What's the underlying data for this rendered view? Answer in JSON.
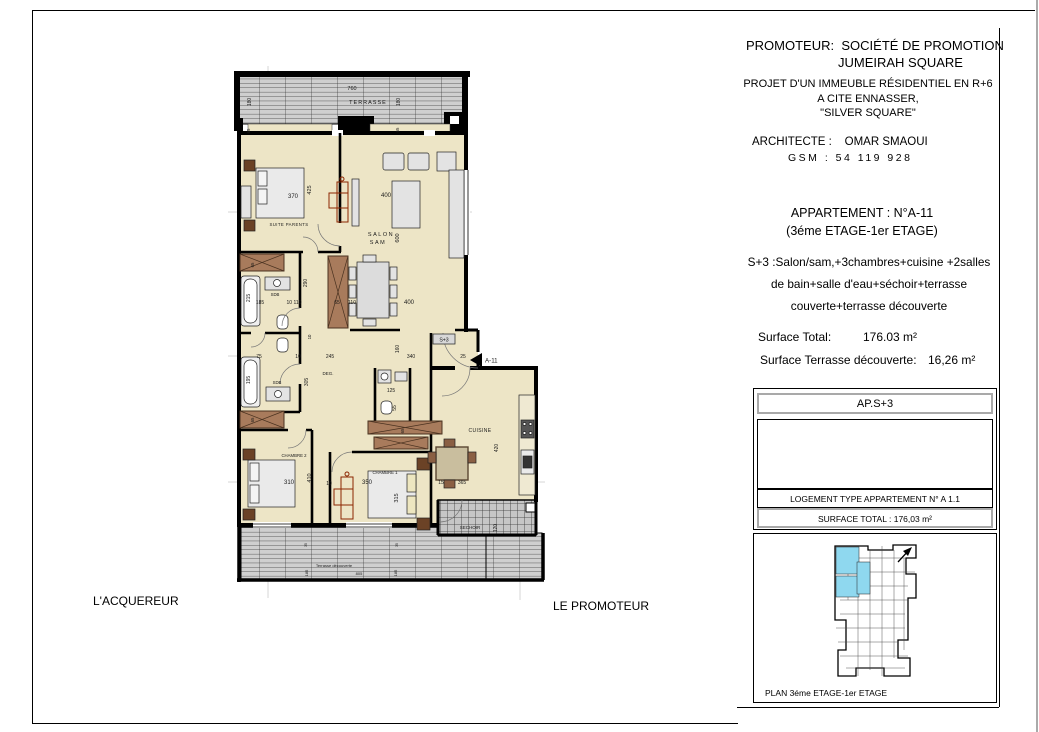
{
  "header": {
    "promoteur_label": "PROMOTEUR:",
    "promoteur_name1": "SOCIÉTÉ DE PROMOTION",
    "promoteur_name2": "JUMEIRAH SQUARE",
    "projet1": "PROJET D'UN IMMEUBLE RÉSIDENTIEL EN  R+6",
    "projet2": "A CITE ENNASSER,",
    "projet3": "\"SILVER SQUARE\"",
    "architecte_label": "ARCHITECTE :",
    "architecte_name": "OMAR SMAOUI",
    "gsm": "GSM : 54 119 928"
  },
  "apartment": {
    "line1": "APPARTEMENT : N°A-11",
    "line2": "(3éme ETAGE-1er ETAGE)",
    "desc1": "S+3 :Salon/sam,+3chambres+cuisine +2salles",
    "desc2": "de bain+salle d'eau+séchoir+terrasse",
    "desc3": "couverte+terrasse découverte",
    "surface_total_label": "Surface Total:",
    "surface_total_value": "176.03 m²",
    "surface_terrasse_label": "Surface Terrasse découverte:",
    "surface_terrasse_value": "16,26 m²"
  },
  "cartouche": {
    "type": "AP.S+3",
    "logement": "LOGEMENT TYPE APPARTEMENT N° A 1.1",
    "surface": "SURFACE TOTAL : 176,03 m²",
    "caption": "PLAN 3éme ETAGE-1er ETAGE"
  },
  "signatures": {
    "acquereur": "L'ACQUEREUR",
    "promoteur": "LE PROMOTEUR"
  },
  "plan": {
    "entrance_tag": "A-11",
    "type_tag": "S+3",
    "labels": [
      {
        "t": "760",
        "x": 352,
        "y": 90,
        "s": 5.5
      },
      {
        "t": "TERRASSE",
        "x": 368,
        "y": 104,
        "s": 5.5,
        "ls": 1
      },
      {
        "t": "180",
        "x": 251,
        "y": 102,
        "s": 5,
        "r": -90
      },
      {
        "t": "180",
        "x": 400,
        "y": 102,
        "s": 5,
        "r": -90
      },
      {
        "t": "65",
        "x": 250,
        "y": 131,
        "s": 4.3,
        "r": -90
      },
      {
        "t": "65",
        "x": 399,
        "y": 130,
        "s": 4.3,
        "r": -90
      },
      {
        "t": "370",
        "x": 293,
        "y": 198,
        "s": 6
      },
      {
        "t": "425",
        "x": 311,
        "y": 190,
        "s": 5.5,
        "r": -90
      },
      {
        "t": "SUITE PARENTS",
        "x": 289,
        "y": 226,
        "s": 4.3,
        "ls": 0.4
      },
      {
        "t": "400",
        "x": 386,
        "y": 197,
        "s": 6
      },
      {
        "t": "SALON",
        "x": 381,
        "y": 236,
        "s": 5.5,
        "ls": 1.5
      },
      {
        "t": "SAM",
        "x": 378,
        "y": 244,
        "s": 5.5,
        "ls": 1.5
      },
      {
        "t": "600",
        "x": 399,
        "y": 238,
        "s": 5.5,
        "r": -90
      },
      {
        "t": "215",
        "x": 250,
        "y": 298,
        "s": 5,
        "r": -90
      },
      {
        "t": "SDB",
        "x": 275,
        "y": 296,
        "s": 4.3
      },
      {
        "t": "185",
        "x": 260,
        "y": 304,
        "s": 5
      },
      {
        "t": "10 110",
        "x": 294,
        "y": 304,
        "s": 5
      },
      {
        "t": "65",
        "x": 337,
        "y": 304,
        "s": 5
      },
      {
        "t": "110",
        "x": 352,
        "y": 304,
        "s": 5
      },
      {
        "t": "400",
        "x": 409,
        "y": 304,
        "s": 6
      },
      {
        "t": "290",
        "x": 307,
        "y": 283,
        "s": 5,
        "r": -90
      },
      {
        "t": "10",
        "x": 311,
        "y": 337,
        "s": 4.3,
        "r": -90
      },
      {
        "t": "75",
        "x": 259,
        "y": 358,
        "s": 5
      },
      {
        "t": "10",
        "x": 298,
        "y": 358,
        "s": 5
      },
      {
        "t": "245",
        "x": 330,
        "y": 358,
        "s": 5
      },
      {
        "t": "160",
        "x": 399,
        "y": 349,
        "s": 5,
        "r": -90
      },
      {
        "t": "340",
        "x": 411,
        "y": 358,
        "s": 5
      },
      {
        "t": "25",
        "x": 463,
        "y": 358,
        "s": 5
      },
      {
        "t": "DEG.",
        "x": 328,
        "y": 375,
        "s": 4.5
      },
      {
        "t": "305",
        "x": 308,
        "y": 382,
        "s": 5,
        "r": -90
      },
      {
        "t": "195",
        "x": 250,
        "y": 380,
        "s": 5,
        "r": -90
      },
      {
        "t": "SDB",
        "x": 277,
        "y": 384,
        "s": 4.3
      },
      {
        "t": "125",
        "x": 391,
        "y": 392,
        "s": 5
      },
      {
        "t": "55",
        "x": 396,
        "y": 408,
        "s": 5,
        "r": -90
      },
      {
        "t": "65",
        "x": 254,
        "y": 265,
        "s": 4.3,
        "r": -90
      },
      {
        "t": "65",
        "x": 254,
        "y": 420,
        "s": 4.3,
        "r": -90
      },
      {
        "t": "65",
        "x": 404,
        "y": 431,
        "s": 4.3,
        "r": -90
      },
      {
        "t": "CUISINE",
        "x": 480,
        "y": 432,
        "s": 5,
        "ls": 0.4
      },
      {
        "t": "420",
        "x": 498,
        "y": 448,
        "s": 5,
        "r": -90
      },
      {
        "t": "15",
        "x": 441,
        "y": 484,
        "s": 5
      },
      {
        "t": "365",
        "x": 462,
        "y": 484,
        "s": 5
      },
      {
        "t": "CHAMBRE 2",
        "x": 294,
        "y": 457,
        "s": 4.3
      },
      {
        "t": "310",
        "x": 289,
        "y": 484,
        "s": 6
      },
      {
        "t": "410",
        "x": 311,
        "y": 478,
        "s": 5.5,
        "r": -90
      },
      {
        "t": "10",
        "x": 329,
        "y": 485,
        "s": 5
      },
      {
        "t": "CHAMBRE 1",
        "x": 385,
        "y": 474,
        "s": 4.3
      },
      {
        "t": "350",
        "x": 367,
        "y": 484,
        "s": 6
      },
      {
        "t": "315",
        "x": 398,
        "y": 498,
        "s": 5.5,
        "r": -90
      },
      {
        "t": "SECHOIR",
        "x": 470,
        "y": 529,
        "s": 4.5
      },
      {
        "t": "120",
        "x": 497,
        "y": 528,
        "s": 5,
        "r": -90
      },
      {
        "t": "35",
        "x": 307,
        "y": 545,
        "s": 3.5,
        "r": -90
      },
      {
        "t": "35",
        "x": 398,
        "y": 545,
        "s": 3.5,
        "r": -90
      },
      {
        "t": "Terrasse découverte",
        "x": 334,
        "y": 567,
        "s": 4
      },
      {
        "t": "805",
        "x": 359,
        "y": 575,
        "s": 4
      },
      {
        "t": "185",
        "x": 308,
        "y": 573,
        "s": 4,
        "r": -90
      },
      {
        "t": "185",
        "x": 397,
        "y": 573,
        "s": 4,
        "r": -90
      }
    ]
  },
  "colors": {
    "floor": "#EDE5C6",
    "wall": "#000000",
    "wood": "#A87B5C",
    "furniture": "#E3E3E3",
    "hatch": "#CDCDCD",
    "highlight": "#8FD8EF",
    "accent_red": "#8B2500"
  }
}
